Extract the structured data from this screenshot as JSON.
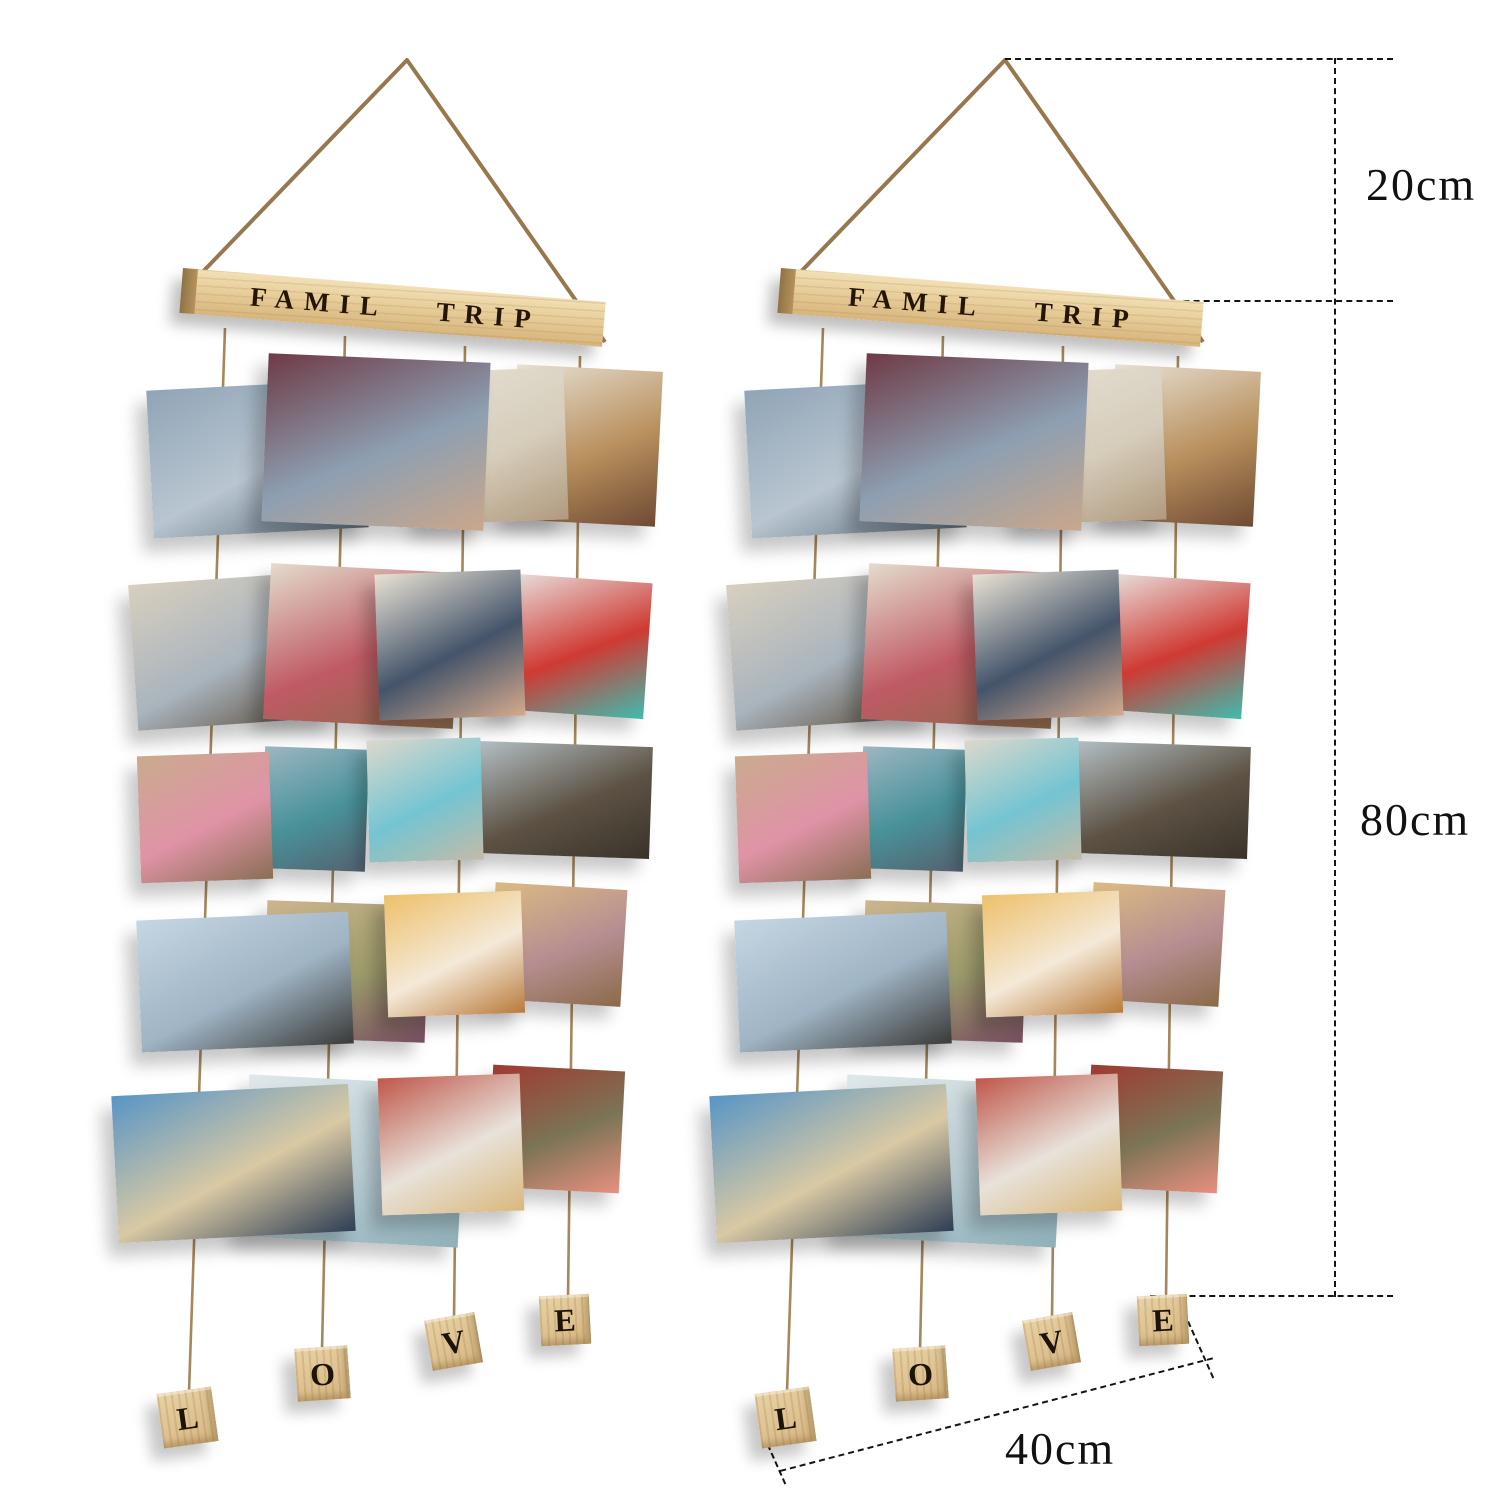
{
  "scene": {
    "description": "Two identical hanging photo display organizers shown side by side with size annotations",
    "title_bar_text": "FAMIL TRIP",
    "blocks": [
      "L",
      "O",
      "V",
      "E"
    ],
    "colors": {
      "background": "#ffffff",
      "wood_light": "#f2e0b6",
      "wood_mid": "#ddbd89",
      "wood_dark": "#8f7345",
      "rope": "#97784e",
      "string": "#a5875a",
      "stamp_letters": "#241505",
      "dimension_line": "#141414"
    }
  },
  "dimensions": {
    "hang_height": "20cm",
    "body_height": "80cm",
    "width": "40cm"
  },
  "photo_rows": [
    {
      "photos": [
        {
          "name": "man-lifting-child-blue-sky",
          "colors": [
            "#90a4b6",
            "#b9c6d1",
            "#5b6b7a"
          ]
        },
        {
          "name": "toddler-maroon-beanie-hug",
          "colors": [
            "#6e3a45",
            "#8d9fb2",
            "#caa78b"
          ]
        },
        {
          "name": "girl-white-brick-wall",
          "colors": [
            "#e6e1d4",
            "#d6cdbb",
            "#b09a7e"
          ]
        },
        {
          "name": "family-indoor-gathering",
          "colors": [
            "#e8e2d6",
            "#b9905e",
            "#6e4a32"
          ]
        }
      ]
    },
    {
      "photos": [
        {
          "name": "mom-holding-baby-livingroom",
          "colors": [
            "#d8cfbf",
            "#a9b4bd",
            "#5a4a3a"
          ]
        },
        {
          "name": "mom-plaid-shirt-with-baby",
          "colors": [
            "#e3dccd",
            "#c05a64",
            "#8a6a4a"
          ]
        },
        {
          "name": "mother-kissing-baby-striped-hat",
          "colors": [
            "#e9e2d4",
            "#44546a",
            "#d4a98c"
          ]
        },
        {
          "name": "baby-red-mickey-outfit",
          "colors": [
            "#e9e7e5",
            "#cf3a33",
            "#3fbcae"
          ]
        }
      ]
    },
    {
      "photos": [
        {
          "name": "parents-holding-toddler-hands",
          "colors": [
            "#c9ab8e",
            "#e093a6",
            "#8a6e54"
          ]
        },
        {
          "name": "couple-mountain-lake",
          "colors": [
            "#9db6c2",
            "#49929a",
            "#53616e"
          ]
        },
        {
          "name": "parents-toddler-beach-walk",
          "colors": [
            "#dcd8cc",
            "#74c4d2",
            "#c3bba8"
          ]
        },
        {
          "name": "family-on-seaside-rocks",
          "colors": [
            "#b3bfc4",
            "#5d5244",
            "#3a332a"
          ]
        }
      ]
    },
    {
      "photos": [
        {
          "name": "dad-tossing-child-sky",
          "colors": [
            "#c6d6e3",
            "#9fb4c4",
            "#3a3a38"
          ]
        },
        {
          "name": "dad-carrying-child-dunes",
          "colors": [
            "#cdb58e",
            "#9a9a6a",
            "#7a4e62"
          ]
        },
        {
          "name": "laughing-child-golden-light",
          "colors": [
            "#eec06a",
            "#f4e9d8",
            "#b97a3a"
          ]
        },
        {
          "name": "mom-daughter-wheat-field",
          "colors": [
            "#dcbb82",
            "#b68e92",
            "#8a6a48"
          ]
        }
      ]
    },
    {
      "photos": [
        {
          "name": "mom-and-kids-beach-stripes",
          "colors": [
            "#5795c6",
            "#d9c9a4",
            "#2e3e54"
          ]
        },
        {
          "name": "children-running-shallow-water",
          "colors": [
            "#dfe7e9",
            "#b9cdd3",
            "#8fb0ba"
          ]
        },
        {
          "name": "woman-kissing-newborn",
          "colors": [
            "#c0574a",
            "#e8e2da",
            "#d9b87c"
          ]
        },
        {
          "name": "couple-kissing-red-barn",
          "colors": [
            "#a03a30",
            "#7c7456",
            "#e8907e"
          ]
        }
      ]
    }
  ]
}
